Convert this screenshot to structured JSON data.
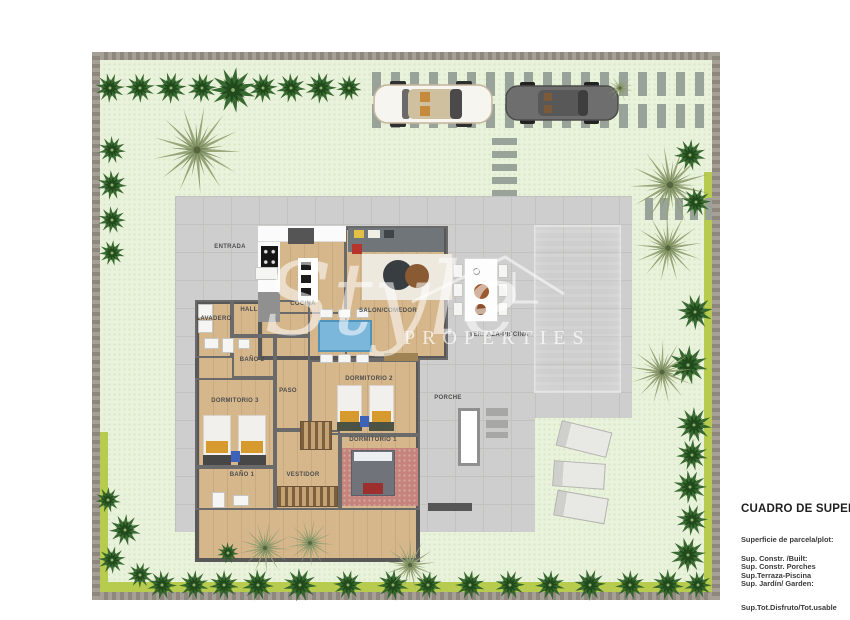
{
  "palette": {
    "lawn": "#e9f2da",
    "grass_strip": "#b7cb4e",
    "wall_band": "#98938a",
    "terrace": "#cecece",
    "pool_water": "#35c4dc",
    "wood_floor": "#d6b78c",
    "interior_wall": "#5f5f5f",
    "bush_green": "#2e6128",
    "palm_olive": "#93a073",
    "label_gray": "#4d4d4d",
    "car_white": "#f7f5f0",
    "car_gray": "#6e6e6e",
    "dining_table_blue": "#7ab7da"
  },
  "watermark": {
    "script": "Style",
    "caption": "PROPERTIES"
  },
  "info_panel": {
    "title": "CUADRO DE SUPERFICIES",
    "subtitle": "Superficie de parcela/plot:",
    "lines": [
      "Sup. Constr. /Built:",
      "Sup. Constr. Porches",
      "Sup.Terraza-Piscina",
      "Sup. Jardín/ Garden:"
    ],
    "footer": "Sup.Tot.Disfruto/Tot.usable"
  },
  "plan_labels": [
    {
      "text": "ENTRADA",
      "x": 138,
      "y": 195
    },
    {
      "text": "COCINA",
      "x": 211,
      "y": 252
    },
    {
      "text": "SALON/COMEDOR",
      "x": 296,
      "y": 259
    },
    {
      "text": "TERRAZA-PISCINA",
      "x": 407,
      "y": 283
    },
    {
      "text": "LAVADERO",
      "x": 122,
      "y": 267
    },
    {
      "text": "HALL",
      "x": 157,
      "y": 258
    },
    {
      "text": "BAÑO 2",
      "x": 160,
      "y": 308
    },
    {
      "text": "PASO",
      "x": 196,
      "y": 339
    },
    {
      "text": "DORMITORIO 3",
      "x": 143,
      "y": 349
    },
    {
      "text": "DORMITORIO 2",
      "x": 277,
      "y": 327
    },
    {
      "text": "DORMITORIO 1",
      "x": 281,
      "y": 388
    },
    {
      "text": "BAÑO 1",
      "x": 150,
      "y": 423
    },
    {
      "text": "VESTIDOR",
      "x": 211,
      "y": 423
    },
    {
      "text": "PORCHE",
      "x": 356,
      "y": 346
    }
  ],
  "rooms": [
    {
      "name": "cocina",
      "x": 166,
      "y": 174,
      "w": 88,
      "h": 88
    },
    {
      "name": "salon-comedor",
      "x": 253,
      "y": 174,
      "w": 103,
      "h": 134
    },
    {
      "name": "lavadero",
      "x": 103,
      "y": 248,
      "w": 37,
      "h": 58
    },
    {
      "name": "hall",
      "x": 140,
      "y": 248,
      "w": 78,
      "h": 36
    },
    {
      "name": "bano-2",
      "x": 140,
      "y": 284,
      "w": 43,
      "h": 42
    },
    {
      "name": "paso",
      "x": 183,
      "y": 284,
      "w": 35,
      "h": 94
    },
    {
      "name": "dormitorio-3",
      "x": 103,
      "y": 326,
      "w": 80,
      "h": 89
    },
    {
      "name": "bano-1",
      "x": 103,
      "y": 415,
      "w": 80,
      "h": 43
    },
    {
      "name": "vestidor",
      "x": 183,
      "y": 378,
      "w": 65,
      "h": 80
    },
    {
      "name": "dormitorio-2",
      "x": 218,
      "y": 308,
      "w": 110,
      "h": 75
    },
    {
      "name": "dormitorio-1",
      "x": 248,
      "y": 383,
      "w": 80,
      "h": 75
    }
  ],
  "trees": [
    {
      "t": "bush",
      "x": 18,
      "y": 36,
      "r": 15
    },
    {
      "t": "bush",
      "x": 48,
      "y": 36,
      "r": 15
    },
    {
      "t": "bush",
      "x": 79,
      "y": 36,
      "r": 16
    },
    {
      "t": "bush",
      "x": 110,
      "y": 36,
      "r": 15
    },
    {
      "t": "bush",
      "x": 141,
      "y": 38,
      "r": 23
    },
    {
      "t": "bush",
      "x": 171,
      "y": 36,
      "r": 15
    },
    {
      "t": "bush",
      "x": 199,
      "y": 36,
      "r": 15
    },
    {
      "t": "bush",
      "x": 229,
      "y": 36,
      "r": 16
    },
    {
      "t": "bush",
      "x": 257,
      "y": 36,
      "r": 13
    },
    {
      "t": "palm",
      "x": 105,
      "y": 98,
      "r": 44
    },
    {
      "t": "bush",
      "x": 20,
      "y": 98,
      "r": 14
    },
    {
      "t": "bush",
      "x": 20,
      "y": 133,
      "r": 15
    },
    {
      "t": "bush",
      "x": 20,
      "y": 168,
      "r": 14
    },
    {
      "t": "bush",
      "x": 20,
      "y": 201,
      "r": 13
    },
    {
      "t": "bush",
      "x": 16,
      "y": 448,
      "r": 13
    },
    {
      "t": "bush",
      "x": 33,
      "y": 478,
      "r": 16
    },
    {
      "t": "bush",
      "x": 20,
      "y": 508,
      "r": 14
    },
    {
      "t": "bush",
      "x": 48,
      "y": 523,
      "r": 13
    },
    {
      "t": "bush",
      "x": 70,
      "y": 533,
      "r": 15
    },
    {
      "t": "bush",
      "x": 102,
      "y": 533,
      "r": 15
    },
    {
      "t": "bush",
      "x": 132,
      "y": 533,
      "r": 15
    },
    {
      "t": "bush",
      "x": 166,
      "y": 533,
      "r": 16
    },
    {
      "t": "bush",
      "x": 208,
      "y": 533,
      "r": 17
    },
    {
      "t": "bush",
      "x": 256,
      "y": 533,
      "r": 15
    },
    {
      "t": "bush",
      "x": 301,
      "y": 533,
      "r": 16
    },
    {
      "t": "bush",
      "x": 336,
      "y": 533,
      "r": 14
    },
    {
      "t": "bush",
      "x": 378,
      "y": 533,
      "r": 15
    },
    {
      "t": "bush",
      "x": 418,
      "y": 533,
      "r": 15
    },
    {
      "t": "bush",
      "x": 458,
      "y": 533,
      "r": 15
    },
    {
      "t": "bush",
      "x": 498,
      "y": 533,
      "r": 16
    },
    {
      "t": "bush",
      "x": 538,
      "y": 533,
      "r": 15
    },
    {
      "t": "bush",
      "x": 576,
      "y": 533,
      "r": 16
    },
    {
      "t": "bush",
      "x": 606,
      "y": 533,
      "r": 14
    },
    {
      "t": "bush",
      "x": 136,
      "y": 501,
      "r": 11
    },
    {
      "t": "palm",
      "x": 173,
      "y": 496,
      "r": 26
    },
    {
      "t": "palm",
      "x": 218,
      "y": 491,
      "r": 24
    },
    {
      "t": "palm",
      "x": 318,
      "y": 513,
      "r": 26
    },
    {
      "t": "palm",
      "x": 578,
      "y": 133,
      "r": 40
    },
    {
      "t": "palm",
      "x": 576,
      "y": 196,
      "r": 34
    },
    {
      "t": "bush",
      "x": 604,
      "y": 150,
      "r": 15
    },
    {
      "t": "bush",
      "x": 598,
      "y": 103,
      "r": 16
    },
    {
      "t": "bush",
      "x": 603,
      "y": 260,
      "r": 18
    },
    {
      "t": "bush",
      "x": 596,
      "y": 313,
      "r": 20
    },
    {
      "t": "palm",
      "x": 570,
      "y": 320,
      "r": 32
    },
    {
      "t": "bush",
      "x": 602,
      "y": 373,
      "r": 18
    },
    {
      "t": "bush",
      "x": 600,
      "y": 403,
      "r": 16
    },
    {
      "t": "bush",
      "x": 598,
      "y": 435,
      "r": 17
    },
    {
      "t": "bush",
      "x": 600,
      "y": 468,
      "r": 16
    },
    {
      "t": "bush",
      "x": 596,
      "y": 503,
      "r": 18
    },
    {
      "t": "palm",
      "x": 528,
      "y": 36,
      "r": 14
    }
  ]
}
